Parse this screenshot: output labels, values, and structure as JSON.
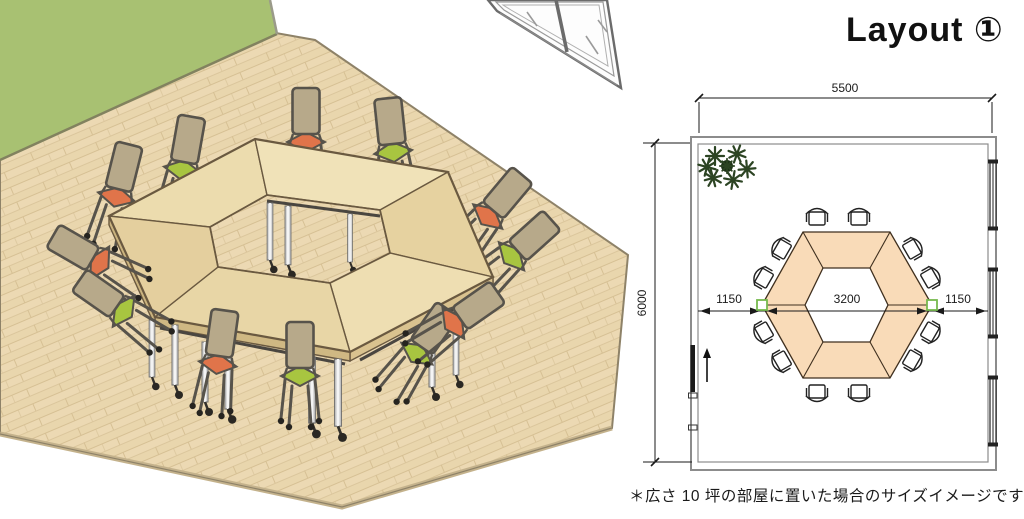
{
  "title": "Layout ①",
  "footnote": "＊広さ 10 坪の部屋に置いた場合のサイズイメージです",
  "floor_plan": {
    "room_width_mm": "5500",
    "room_height_mm": "6000",
    "left_clearance_mm": "1150",
    "table_span_mm": "3200",
    "right_clearance_mm": "1150"
  },
  "colors": {
    "wall_green": "#a8c172",
    "floor_wood": "#ecd9b3",
    "floor_seam": "#d6c094",
    "table_wood": "#ebd9ac",
    "table_edge": "#6a5940",
    "plan_table_fill": "#f9dbb8",
    "plan_outline": "#3f2f1e",
    "seat_orange": "#e0744a",
    "seat_green": "#a8c540",
    "chair_back_tan": "#b7a98a",
    "chair_frame": "#57534b",
    "wall_line_gray": "#8c8c8c",
    "dimension_black": "#1a1a1a",
    "marker_green": "#76b94e",
    "plant_green": "#2c4423",
    "metal_silver": "#d8d8d8"
  }
}
